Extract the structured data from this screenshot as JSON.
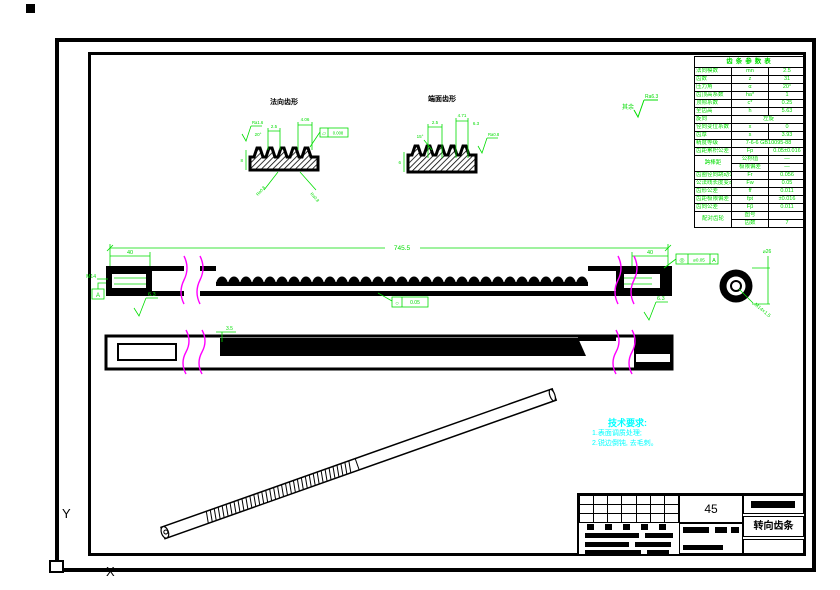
{
  "frame": {
    "ucs_y": "Y",
    "ucs_x": "X"
  },
  "general_note": {
    "prefix": "其余",
    "value": "Ra6.3"
  },
  "details": {
    "left": {
      "label": "法向齿形",
      "angle": "20°",
      "d1": "2.5",
      "d2": "4.06",
      "h": "8",
      "rough_left": "Ra1.6",
      "frame_sym": "▱",
      "frame_val": "0.008",
      "flank1": "Ra0.8",
      "flank2": "Ra0.8"
    },
    "right": {
      "label": "端面齿形",
      "angle": "15°",
      "d1": "2.5",
      "d2": "4.71",
      "d3": "6.3",
      "h": "6",
      "rough": "Ra0.8"
    }
  },
  "main": {
    "len": "745.5",
    "off_l": "40",
    "off_r": "40",
    "datum": "A",
    "thread_l": "M14",
    "rough_l": "6.3",
    "rough_r": "6.3",
    "tol_mid_sym": "○",
    "tol_mid_val": "0.05",
    "tol_r_sym": "◎",
    "tol_r_val": "⌀0.05",
    "tol_r_datum": "A",
    "end_thread": "M14×1.5",
    "end_dia": "⌀26"
  },
  "side": {
    "dim": "3.5"
  },
  "tech": {
    "title": "技术要求:",
    "line1": "1.表面调质处理;",
    "line2": "2.锐边倒钝, 去毛刺。"
  },
  "gt": {
    "title": "齿条参数表",
    "r1": [
      "法向模数",
      "mn",
      "2.5"
    ],
    "r2": [
      "齿数",
      "z",
      "31"
    ],
    "r3": [
      "压力角",
      "α",
      "20°"
    ],
    "r4": [
      "齿顶高系数",
      "ha*",
      "1"
    ],
    "r5": [
      "顶隙系数",
      "c*",
      "0.25"
    ],
    "r6": [
      "全齿高",
      "h",
      "5.63"
    ],
    "r7": [
      "旋向",
      "左旋"
    ],
    "r8": [
      "径向变位系数",
      "x",
      "0"
    ],
    "r9": [
      "齿厚",
      "s",
      "3.93"
    ],
    "r10": [
      "精度等级",
      "7-6-6 GB10095-88"
    ],
    "r11": [
      "齿距累积公差",
      "Fp",
      "0.05±0.016"
    ],
    "g1": {
      "label": "跨棒距",
      "a": [
        "公称值",
        "—"
      ],
      "b": [
        "极限偏差",
        "—"
      ]
    },
    "r12": [
      "齿圈径向跳动公差",
      "Fr",
      "0.056"
    ],
    "r13": [
      "公法线长度变动公差",
      "Fw",
      "0.05"
    ],
    "r14": [
      "齿形公差",
      "ff",
      "0.011"
    ],
    "r15": [
      "齿距极限偏差",
      "fpt",
      "±0.016"
    ],
    "r16": [
      "齿向公差",
      "Fβ",
      "0.011"
    ],
    "g2": {
      "label": "配对齿轮",
      "a": [
        "图号",
        ""
      ],
      "b": [
        "齿数",
        "7"
      ]
    }
  },
  "title_block": {
    "material": "45",
    "part": "转向齿条"
  }
}
